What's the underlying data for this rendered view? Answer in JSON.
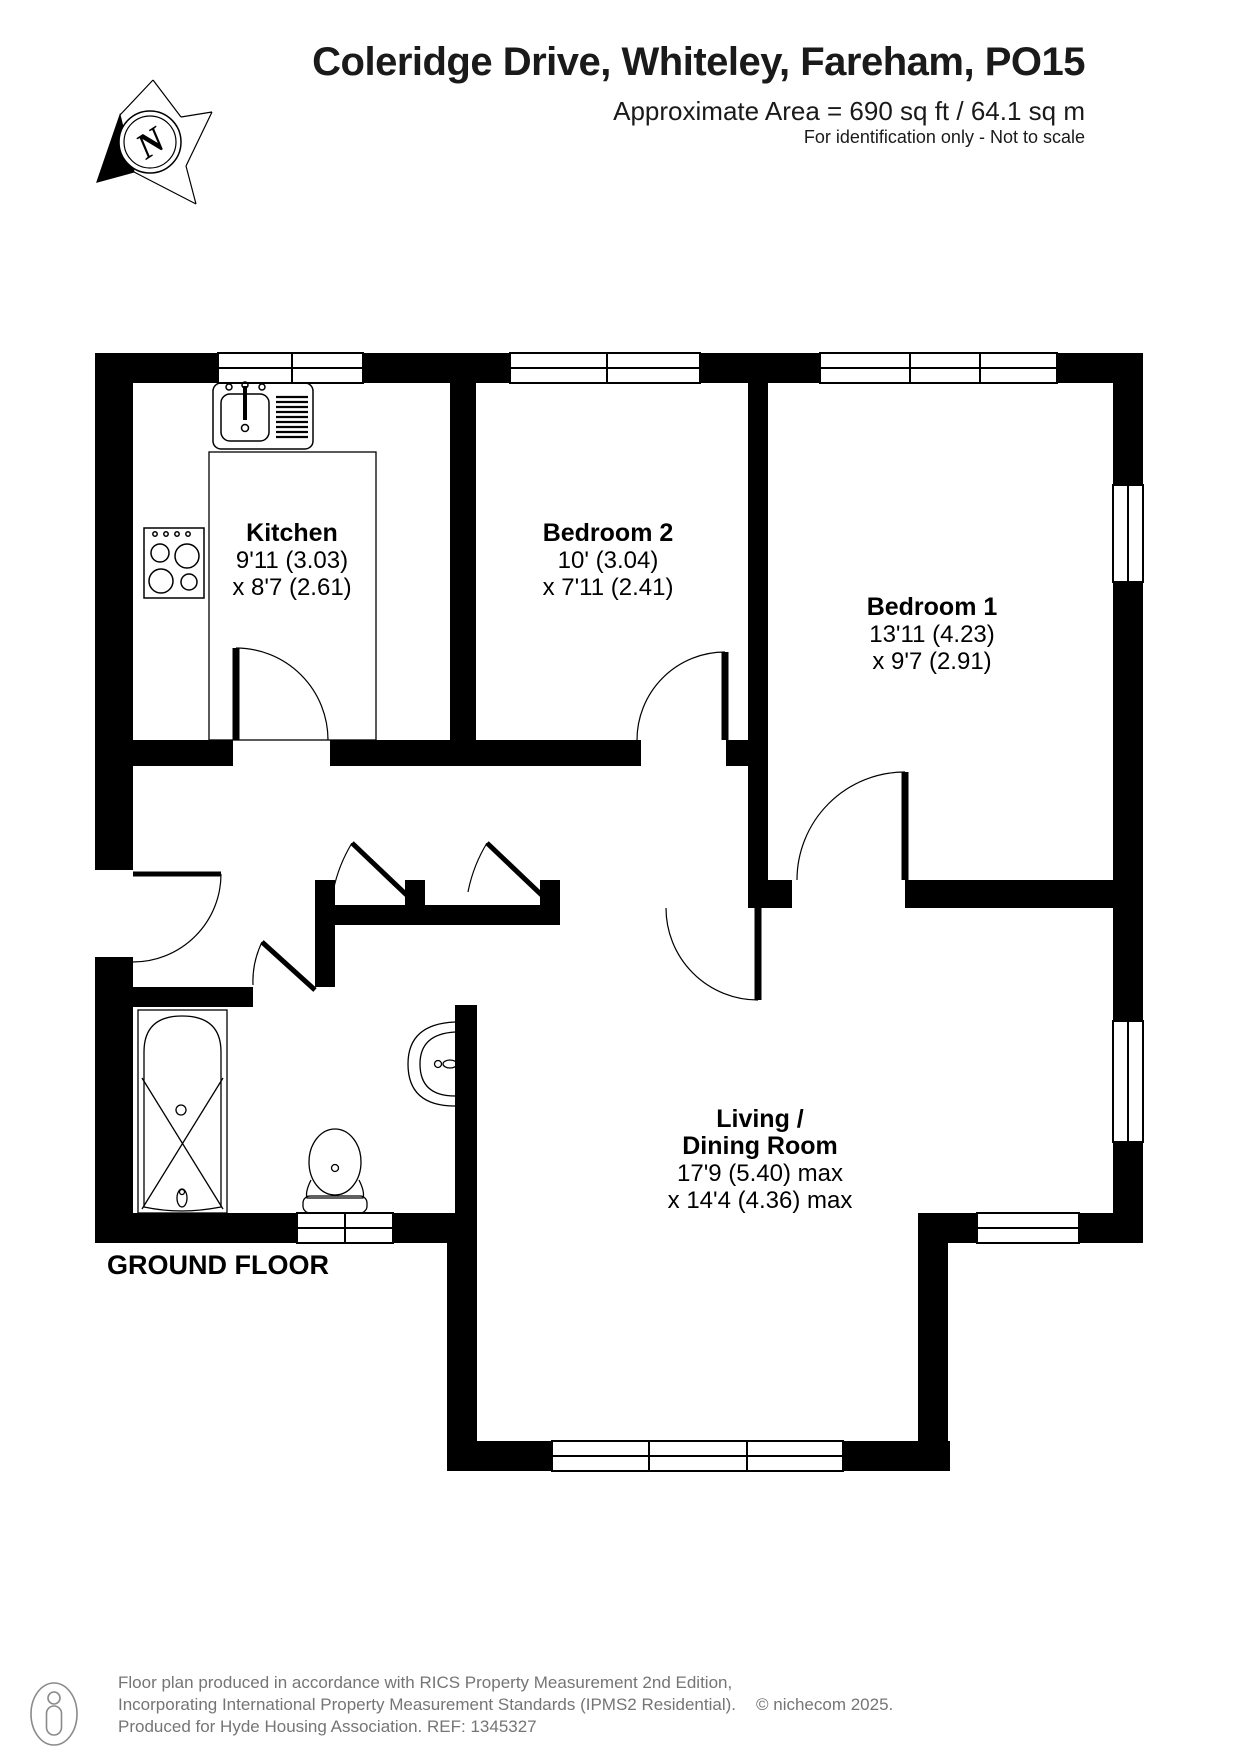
{
  "header": {
    "title": "Coleridge Drive, Whiteley, Fareham, PO15",
    "area": "Approximate Area = 690 sq ft / 64.1 sq m",
    "note": "For identification only - Not to scale"
  },
  "compass": {
    "letter": "N"
  },
  "floor_label": "GROUND FLOOR",
  "rooms": {
    "kitchen": {
      "name": "Kitchen",
      "dim1": "9'11 (3.03)",
      "dim2": "x 8'7 (2.61)"
    },
    "bedroom2": {
      "name": "Bedroom 2",
      "dim1": "10' (3.04)",
      "dim2": "x 7'11 (2.41)"
    },
    "bedroom1": {
      "name": "Bedroom 1",
      "dim1": "13'11 (4.23)",
      "dim2": "x 9'7 (2.91)"
    },
    "living": {
      "name1": "Living /",
      "name2": "Dining Room",
      "dim1": "17'9 (5.40) max",
      "dim2": "x 14'4 (4.36) max"
    }
  },
  "footer": {
    "line1": "Floor plan produced in accordance with RICS Property Measurement 2nd Edition,",
    "line2": "Incorporating International Property Measurement Standards (IPMS2 Residential).",
    "copyright": "© nichecom 2025.",
    "line3": "Produced for Hyde Housing Association.  REF: 1345327"
  },
  "colors": {
    "wall": "#000000",
    "text": "#1a1a1a",
    "footer_text": "#757575",
    "background": "#ffffff"
  }
}
